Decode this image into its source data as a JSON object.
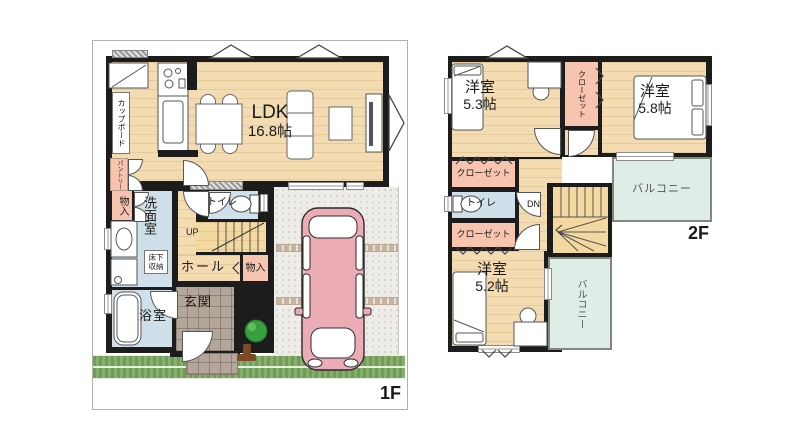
{
  "floor1": {
    "label": "1F",
    "ldk_name": "LDK",
    "ldk_size": "16.8帖",
    "cupboard": "カップボード",
    "pantry": "パントリー",
    "storage1": "物入",
    "washroom": "洗面室",
    "underfloor_storage": "床下収納",
    "bathroom": "浴室",
    "toilet": "トイレ",
    "stairs_up": "UP",
    "hall": "ホール",
    "storage2": "物入",
    "entrance": "玄関"
  },
  "floor2": {
    "label": "2F",
    "room1_name": "洋室",
    "room1_size": "5.3帖",
    "room2_name": "洋室",
    "room2_size": "5.8帖",
    "room3_name": "洋室",
    "room3_size": "5.2帖",
    "closet_upper": "クローゼット",
    "closet_mid": "クローゼット",
    "closet_low": "クローゼット",
    "toilet": "トイレ",
    "stairs_down": "DN",
    "balcony_right": "バルコニー",
    "balcony_bottom": "バルコニー"
  },
  "colors": {
    "wall": "#1c1c1c",
    "wood_floor": "#f3dcb2",
    "wet_floor": "#cfe0ea",
    "closet_pink": "#f7c4b0",
    "balcony_mint": "#deeee6",
    "car_pink": "#ecacb6",
    "grass_green": "#6f9c59"
  }
}
